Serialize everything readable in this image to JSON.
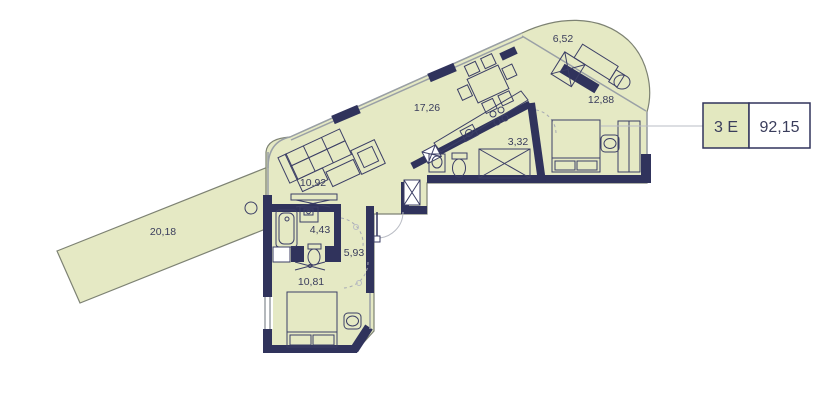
{
  "plan": {
    "badge": {
      "type_label": "3 Е",
      "total_area": "92,15"
    },
    "rooms": [
      {
        "id": "terrace",
        "area": "6,52"
      },
      {
        "id": "bedroom-2",
        "area": "12,88"
      },
      {
        "id": "living-kitchen",
        "area": "17,26"
      },
      {
        "id": "bathroom-2",
        "area": "3,32"
      },
      {
        "id": "living-zone",
        "area": "10,92"
      },
      {
        "id": "bathroom-1",
        "area": "4,43"
      },
      {
        "id": "hallway",
        "area": "5,93"
      },
      {
        "id": "bedroom-1",
        "area": "10,81"
      },
      {
        "id": "balcony",
        "area": "20,18"
      }
    ],
    "furniture_icons": [
      "sofa-icon",
      "armchair-icon",
      "coffee-table-icon",
      "tv-stand-icon",
      "dining-table-icon",
      "dining-chair-icon",
      "kitchen-counter-icon",
      "stove-icon",
      "kitchen-sink-icon",
      "bathtub-icon",
      "washbasin-icon",
      "washing-machine-icon",
      "toilet-icon",
      "shower-icon",
      "bed-icon",
      "pillow-icon",
      "wardrobe-icon",
      "pouf-icon",
      "desk-icon",
      "desk-chair-icon",
      "door-swing-icon",
      "ceiling-fan-icon"
    ],
    "colors": {
      "floor": "#e5e9c4",
      "wall": "#30335c",
      "glass": "#9aa0a6",
      "badge_fill": "#e3e8c0",
      "text": "#3a3d5c",
      "background": "#ffffff"
    }
  }
}
